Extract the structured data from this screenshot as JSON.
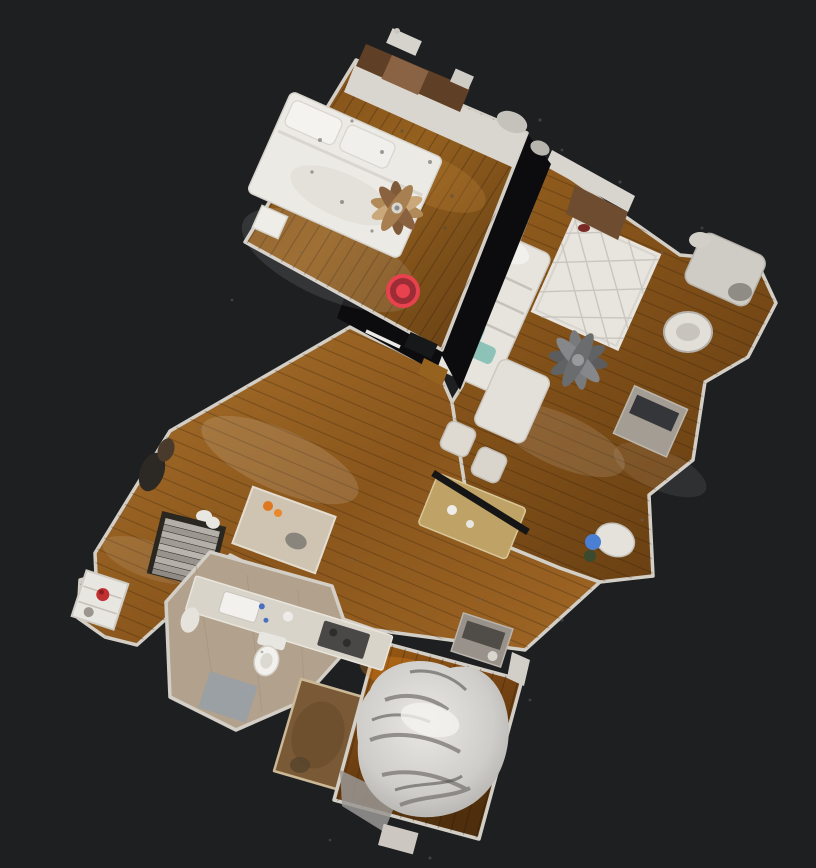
{
  "scene": {
    "view": "dollhouse-floorplan",
    "background": "#1e1f21",
    "marker": {
      "x": 403,
      "y": 291,
      "outer_r": 17,
      "ring_r": 10,
      "dot_r": 5.5,
      "color": "#e8424e",
      "ring_color": "#9c2d36"
    },
    "palette": {
      "wall": "#d5d1c8",
      "wall_gap": "#0c0c0e",
      "wood_bedroom": "#8a5620",
      "wood_living": "#96601f",
      "wood_hall": "#a9722c",
      "wood_bedroom2": "#9c5c14",
      "tile_beige": "#b2a18c",
      "carpet_brown": "#7a5a36",
      "bed_white": "#eceae5",
      "sofa_white": "#e7e4de",
      "rug_white": "#eceae6",
      "mat_gray": "#9aa0a3",
      "pillow_teal": "#9ecdc3",
      "pillow_teal_dark": "#8cc2b8",
      "bag_blue": "#4a7fd4",
      "extinguisher_red": "#c03030",
      "fruit_orange": "#dd7820",
      "stove_dark": "#4a4846",
      "stairs_gray": "#b4b0a9"
    },
    "rooms": [
      {
        "name": "master-bedroom",
        "floor": "wood"
      },
      {
        "name": "living-room",
        "floor": "wood"
      },
      {
        "name": "hallway-entry",
        "floor": "wood"
      },
      {
        "name": "kitchen",
        "floor": "tile"
      },
      {
        "name": "bathroom",
        "floor": "tile"
      },
      {
        "name": "bedroom-2",
        "floor": "wood"
      },
      {
        "name": "carpet-closet",
        "floor": "carpet"
      },
      {
        "name": "staircase",
        "floor": "stairs"
      }
    ]
  }
}
